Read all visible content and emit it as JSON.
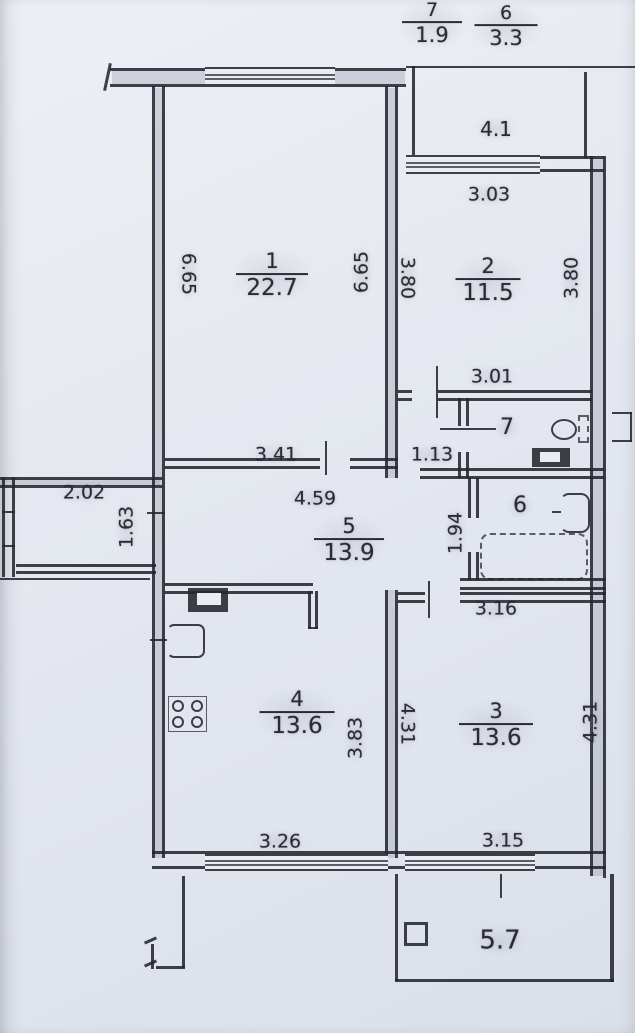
{
  "document": {
    "kind": "scanned apartment floor plan drawing",
    "paper_color": "#e6e9f0",
    "ink_color": "#26272e"
  },
  "plan": {
    "fraction_labels": [
      {
        "name": "balcony-7-label",
        "number": "7",
        "area": "1.9",
        "x": 432,
        "y": 24,
        "num_size": 19,
        "area_size": 21,
        "bar_w": 52
      },
      {
        "name": "balcony-6-label",
        "number": "6",
        "area": "3.3",
        "x": 506,
        "y": 27,
        "num_size": 19,
        "area_size": 21,
        "bar_w": 55
      },
      {
        "name": "room-1-label",
        "number": "1",
        "area": "22.7",
        "x": 272,
        "y": 276,
        "num_size": 21,
        "area_size": 23,
        "bar_w": 64
      },
      {
        "name": "room-2-label",
        "number": "2",
        "area": "11.5",
        "x": 488,
        "y": 281,
        "num_size": 21,
        "area_size": 23,
        "bar_w": 57
      },
      {
        "name": "room-5-label",
        "number": "5",
        "area": "13.9",
        "x": 349,
        "y": 541,
        "num_size": 21,
        "area_size": 23,
        "bar_w": 62
      },
      {
        "name": "room-4-label",
        "number": "4",
        "area": "13.6",
        "x": 297,
        "y": 714,
        "num_size": 21,
        "area_size": 23,
        "bar_w": 67
      },
      {
        "name": "room-3-label",
        "number": "3",
        "area": "13.6",
        "x": 496,
        "y": 726,
        "num_size": 21,
        "area_size": 23,
        "bar_w": 66
      }
    ],
    "plain_labels": [
      {
        "name": "room-7-label",
        "text": "7",
        "x": 507,
        "y": 428,
        "size": 22,
        "rot": 0
      },
      {
        "name": "room-6-label",
        "text": "6",
        "x": 520,
        "y": 506,
        "size": 22,
        "rot": 0
      },
      {
        "name": "balcony-bottom-area-label",
        "text": "5.7",
        "x": 500,
        "y": 941,
        "size": 26,
        "rot": 0
      }
    ],
    "dimensions": [
      {
        "name": "dim-balcony2-width",
        "text": "4.1",
        "x": 496,
        "y": 129,
        "size": 20,
        "rot": 0
      },
      {
        "name": "dim-room2-top",
        "text": "3.03",
        "x": 489,
        "y": 195,
        "size": 19,
        "rot": 0
      },
      {
        "name": "dim-room1-left",
        "text": "6.65",
        "x": 188,
        "y": 274,
        "size": 19,
        "rot": 90
      },
      {
        "name": "dim-room1-right",
        "text": "6.65",
        "x": 362,
        "y": 272,
        "size": 19,
        "rot": -90
      },
      {
        "name": "dim-room2-left",
        "text": "3.80",
        "x": 407,
        "y": 278,
        "size": 19,
        "rot": 90
      },
      {
        "name": "dim-room2-right",
        "text": "3.80",
        "x": 572,
        "y": 278,
        "size": 19,
        "rot": -90
      },
      {
        "name": "dim-wc-top",
        "text": "3.01",
        "x": 492,
        "y": 377,
        "size": 19,
        "rot": 0
      },
      {
        "name": "dim-room1-bottom",
        "text": "3.41",
        "x": 276,
        "y": 455,
        "size": 19,
        "rot": 0
      },
      {
        "name": "dim-vestibule",
        "text": "1.13",
        "x": 432,
        "y": 455,
        "size": 19,
        "rot": 0
      },
      {
        "name": "dim-hall-width",
        "text": "4.59",
        "x": 315,
        "y": 499,
        "size": 19,
        "rot": 0
      },
      {
        "name": "dim-bath-height",
        "text": "1.94",
        "x": 456,
        "y": 533,
        "size": 19,
        "rot": -90
      },
      {
        "name": "dim-balcony-left-width",
        "text": "2.02",
        "x": 84,
        "y": 493,
        "size": 19,
        "rot": 0
      },
      {
        "name": "dim-balcony-left-height",
        "text": "1.63",
        "x": 127,
        "y": 527,
        "size": 19,
        "rot": -90
      },
      {
        "name": "dim-room3-top",
        "text": "3.16",
        "x": 496,
        "y": 609,
        "size": 19,
        "rot": 0
      },
      {
        "name": "dim-room4-right",
        "text": "3.83",
        "x": 356,
        "y": 738,
        "size": 19,
        "rot": -90
      },
      {
        "name": "dim-room3-left",
        "text": "4.31",
        "x": 407,
        "y": 724,
        "size": 19,
        "rot": 90
      },
      {
        "name": "dim-room3-right",
        "text": "4.31",
        "x": 591,
        "y": 722,
        "size": 19,
        "rot": -90
      },
      {
        "name": "dim-room4-bottom",
        "text": "3.26",
        "x": 280,
        "y": 842,
        "size": 19,
        "rot": 0
      },
      {
        "name": "dim-room3-bottom",
        "text": "3.15",
        "x": 503,
        "y": 841,
        "size": 19,
        "rot": 0
      }
    ],
    "fixtures": [
      {
        "name": "wc-sink"
      },
      {
        "name": "wc-toilet"
      },
      {
        "name": "bathroom-toilet"
      },
      {
        "name": "bathtub"
      },
      {
        "name": "kitchen-sink"
      },
      {
        "name": "kitchen-appliance"
      },
      {
        "name": "kitchen-stove"
      },
      {
        "name": "balcony-column-symbol"
      }
    ]
  }
}
